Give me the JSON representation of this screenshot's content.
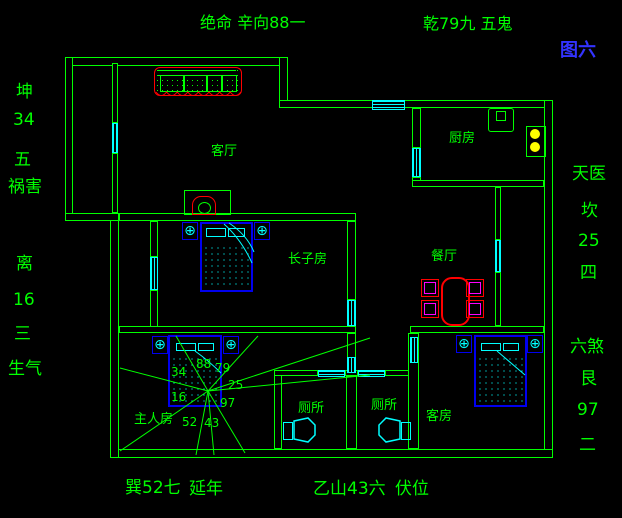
{
  "figure_label": "图六",
  "top_annotations": [
    "绝命 辛向88一",
    "乾79九 五鬼"
  ],
  "left_annotations": [
    "坤",
    "34",
    "五",
    "祸害",
    "离",
    "16",
    "三",
    "生气"
  ],
  "right_annotations": [
    "天医",
    "坎",
    "25",
    "四",
    "六煞",
    "艮",
    "97",
    "二"
  ],
  "bottom_annotations": [
    "巽52七",
    "延年",
    "乙山43六",
    "伏位"
  ],
  "rooms": {
    "living_room": "客厅",
    "kitchen": "厨房",
    "dining_room": "餐厅",
    "eldest_son_room": "长子房",
    "master_room": "主人房",
    "toilet_1": "厕所",
    "toilet_2": "厕所",
    "guest_room": "客房"
  },
  "compass_numbers": [
    "88",
    "79",
    "34",
    "25",
    "16",
    "97",
    "52",
    "43"
  ],
  "nightstand_symbol": "⊕",
  "colors": {
    "background": "#000000",
    "wall_green": "#00ff00",
    "window_cyan": "#00ffff",
    "bed_blue": "#0000ee",
    "accent_red": "#ff0000",
    "chair_magenta": "#ff00ff",
    "stove_yellow": "#ffff00",
    "figure_label_blue": "#3333ff"
  }
}
